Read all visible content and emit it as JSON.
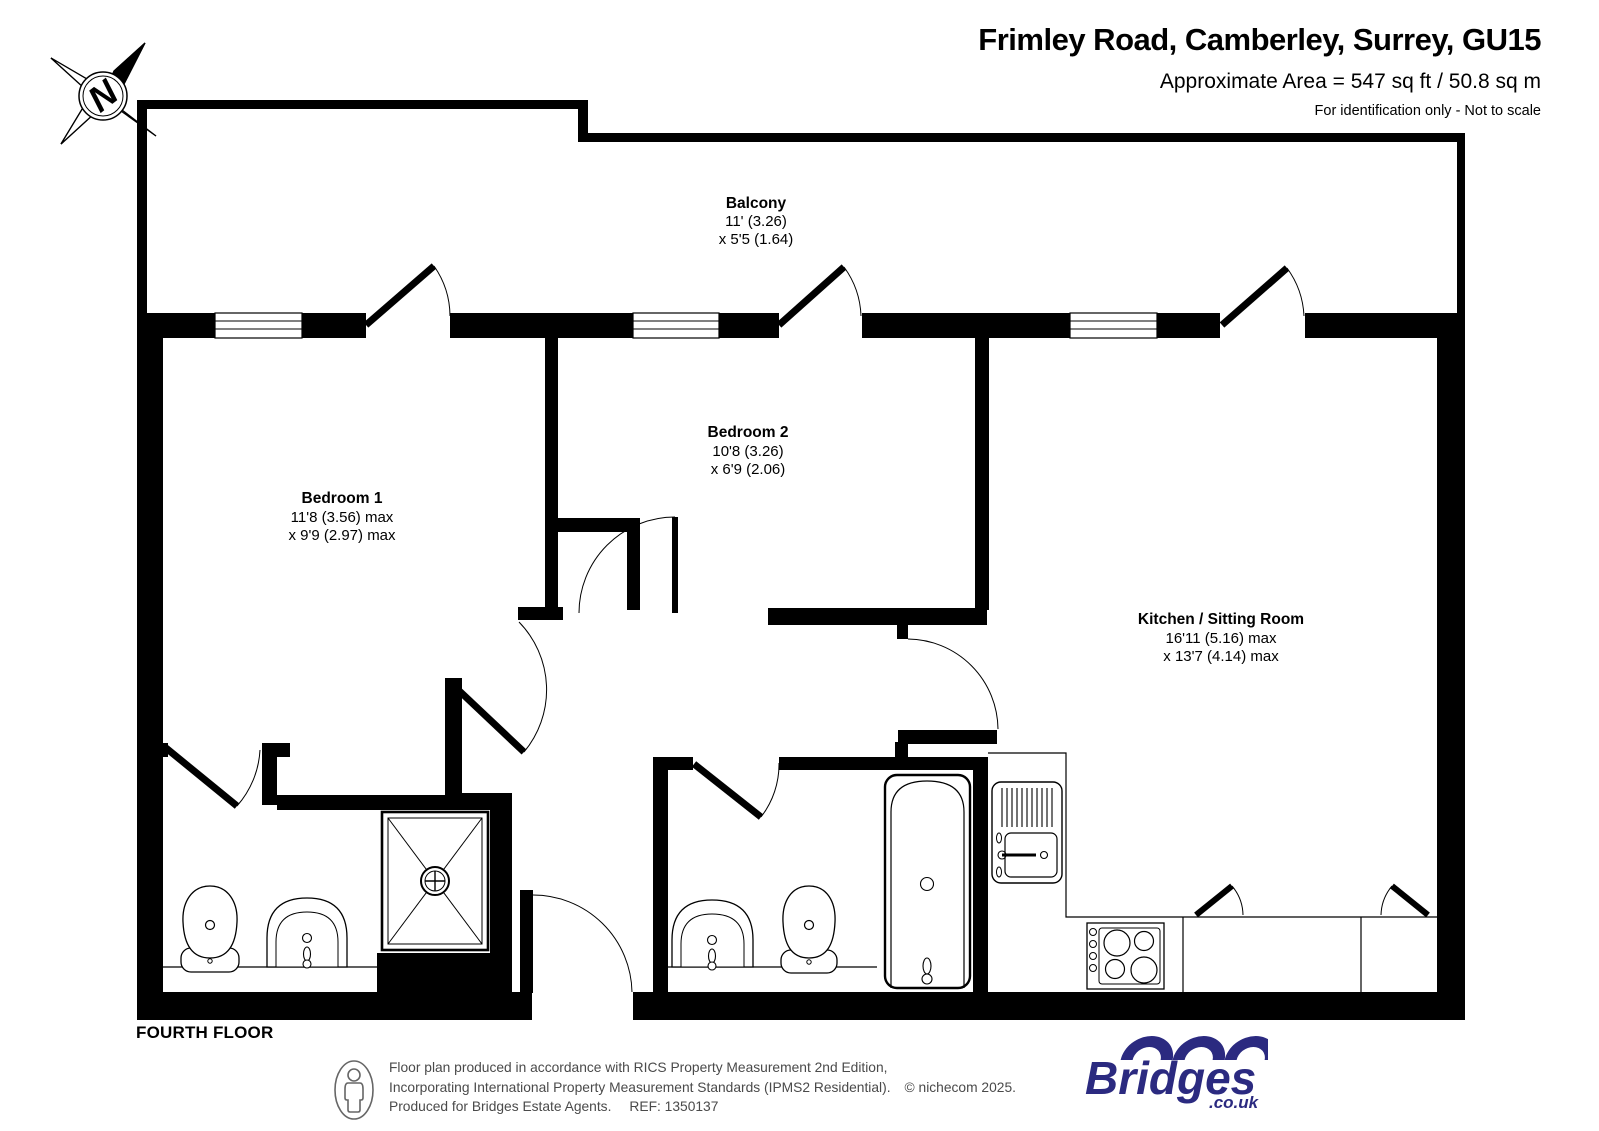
{
  "header": {
    "title": "Frimley Road, Camberley, Surrey, GU15",
    "area": "Approximate Area = 547 sq ft / 50.8 sq m",
    "disclaimer": "For identification only - Not to scale"
  },
  "compass": {
    "label": "N"
  },
  "floor_label": "FOURTH FLOOR",
  "rooms": {
    "balcony": {
      "name": "Balcony",
      "dim1": "11' (3.26)",
      "dim2": "x 5'5 (1.64)"
    },
    "bedroom1": {
      "name": "Bedroom 1",
      "dim1": "11'8 (3.56) max",
      "dim2": "x 9'9 (2.97) max"
    },
    "bedroom2": {
      "name": "Bedroom 2",
      "dim1": "10'8 (3.26)",
      "dim2": "x 6'9 (2.06)"
    },
    "kitchen_sitting": {
      "name": "Kitchen / Sitting Room",
      "dim1": "16'11 (5.16) max",
      "dim2": "x 13'7 (4.14) max"
    }
  },
  "footer": {
    "line1": "Floor plan produced in accordance with RICS Property Measurement 2nd Edition,",
    "line2": "Incorporating International Property Measurement Standards (IPMS2 Residential).",
    "copyright": "© nichecom 2025.",
    "line3": "Produced for Bridges Estate Agents.",
    "ref": "REF: 1350137",
    "logo": {
      "name": "Bridges",
      "suffix": ".co.uk"
    }
  },
  "colors": {
    "wall": "#000000",
    "logo_navy": "#2b2a80",
    "footer_text": "#4a4a4a"
  }
}
